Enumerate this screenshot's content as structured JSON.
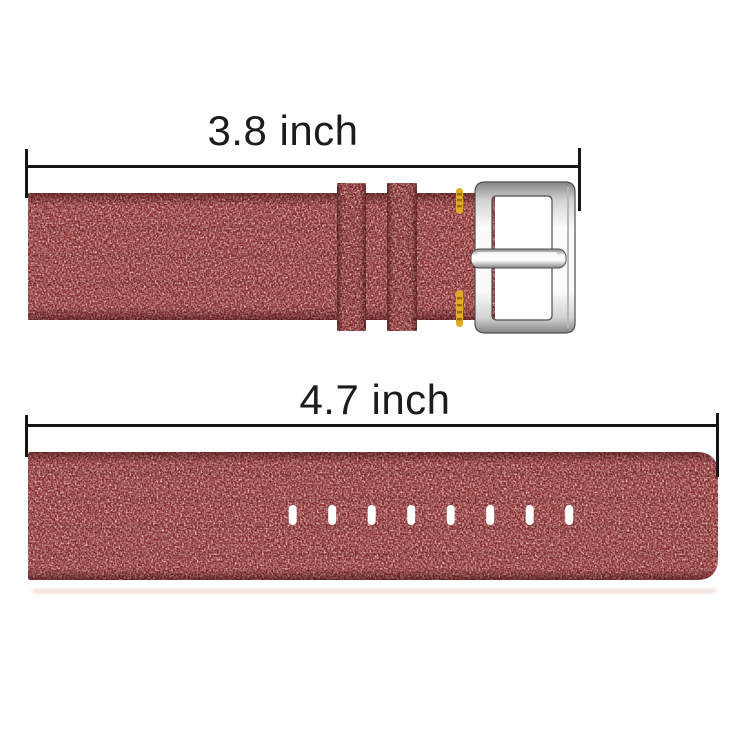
{
  "figure": {
    "background": "#ffffff",
    "annotation": {
      "line_color": "#161616",
      "text_color": "#1c1c1c",
      "top_label": "3.8 inch",
      "bottom_label": "4.7 inch"
    },
    "fabric": {
      "base": "#802425",
      "keeper_base": "#701d1d",
      "dark_speckle": "#4a0e0e",
      "light_speckle": "#d99090",
      "shadow": "#d8a09a"
    },
    "stitch": {
      "gold": "#e3aa26",
      "gold_dark": "#9a6c08"
    },
    "buckle": {
      "silver_light": "#fbfbfb",
      "silver_mid": "#d2d2d2",
      "silver_dark": "#858585",
      "outline": "#4e4e4e"
    },
    "holes": {
      "count": 8,
      "color": "#ffffff"
    }
  }
}
